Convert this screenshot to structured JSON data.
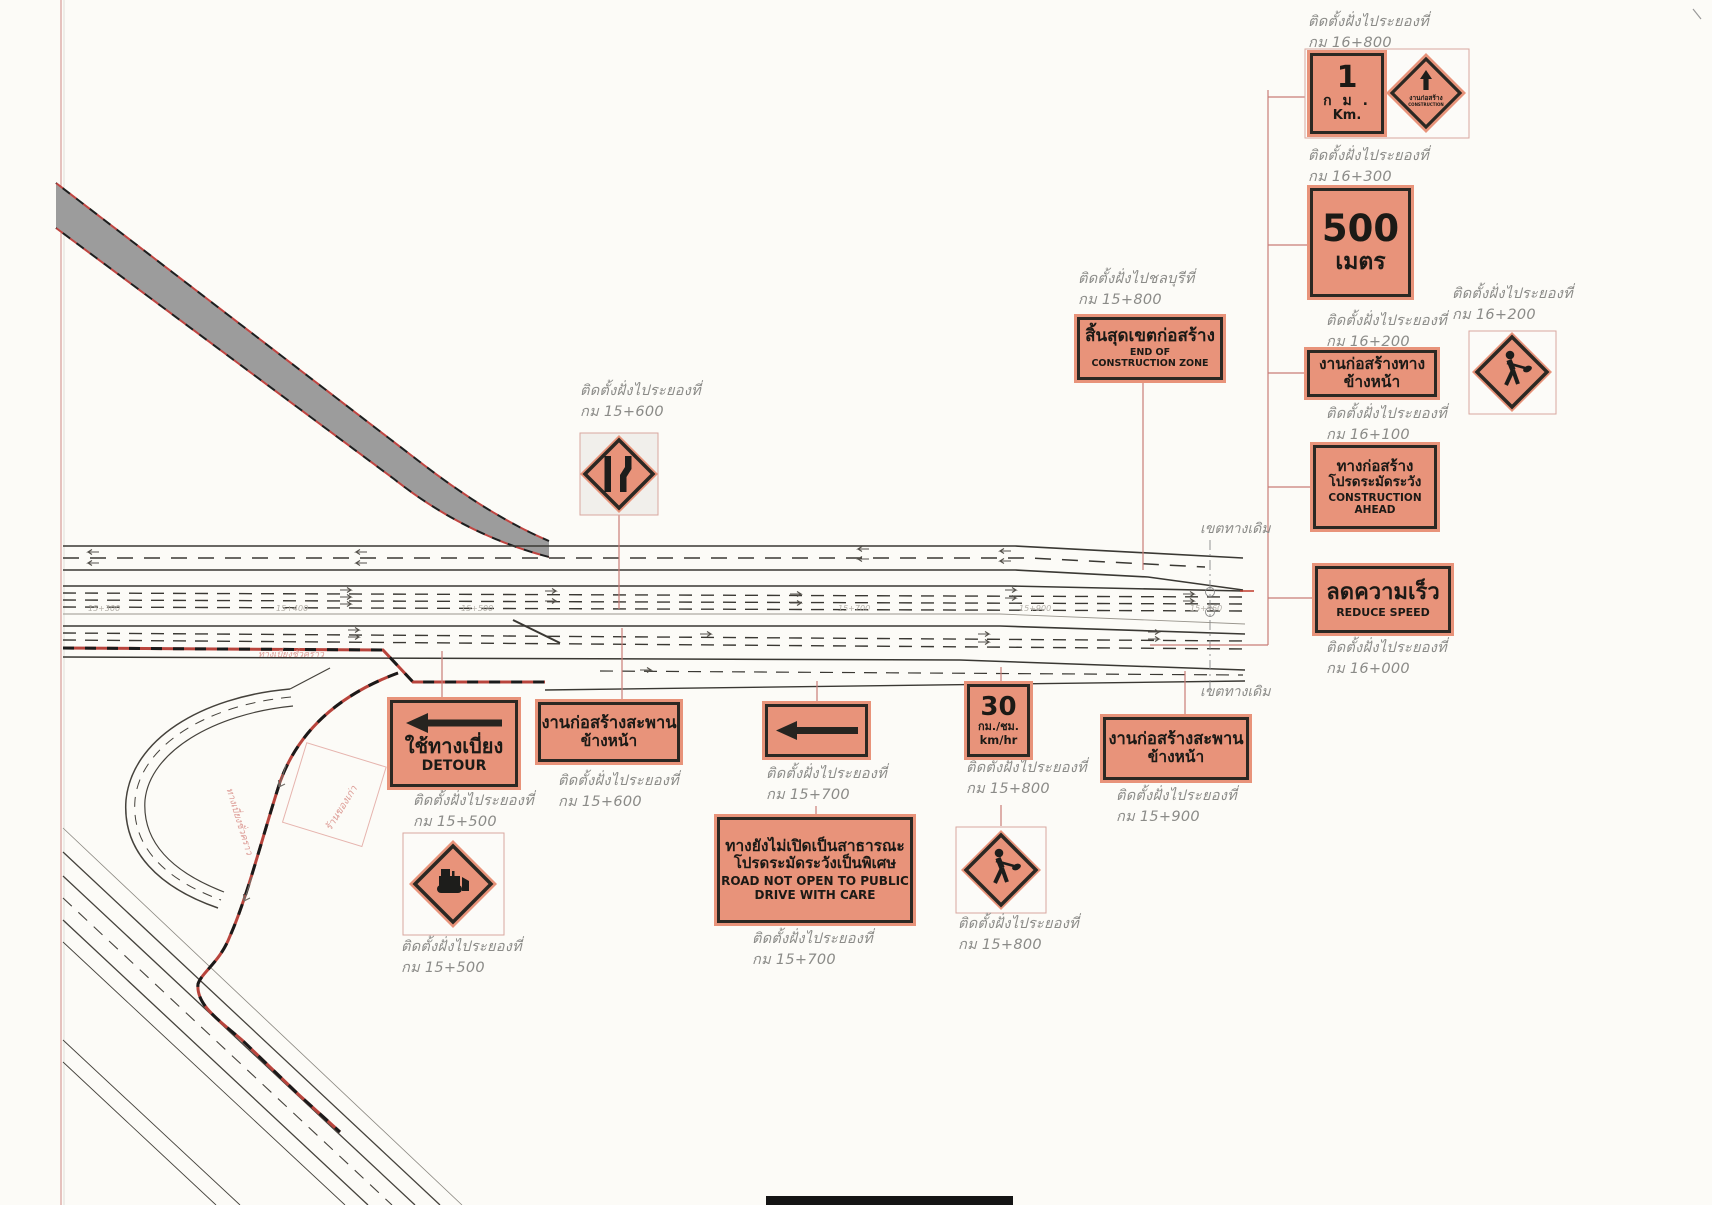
{
  "colors": {
    "sign_background": "#e8937a",
    "sign_border": "#2b2823",
    "leader_line": "#c97d77",
    "detour_route": "#b8443c",
    "label_text": "#8b8b88"
  },
  "placements": [
    {
      "prefix": "ติดตั้งฝั่งไประยองที่",
      "km": "กม  16+800"
    },
    {
      "prefix": "ติดตั้งฝั่งไประยองที่",
      "km": "กม  16+300"
    },
    {
      "prefix": "ติดตั้งฝั่งไประยองที่",
      "km": "กม  16+200"
    },
    {
      "prefix": "ติดตั้งฝั่งไประยองที่",
      "km": "กม  16+200"
    },
    {
      "prefix": "ติดตั้งฝั่งไประยองที่",
      "km": "กม  16+100"
    },
    {
      "prefix": "ติดตั้งฝั่งไประยองที่",
      "km": "กม  16+000"
    },
    {
      "prefix": "ติดตั้งฝั่งไปชลบุรีที่",
      "km": "กม  15+800"
    },
    {
      "prefix": "ติดตั้งฝั่งไประยองที่",
      "km": "กม  15+600"
    },
    {
      "prefix": "ติดตั้งฝั่งไประยองที่",
      "km": "กม  15+500"
    },
    {
      "prefix": "ติดตั้งฝั่งไประยองที่",
      "km": "กม  15+600"
    },
    {
      "prefix": "ติดตั้งฝั่งไประยองที่",
      "km": "กม  15+500"
    },
    {
      "prefix": "ติดตั้งฝั่งไประยองที่",
      "km": "กม  15+700"
    },
    {
      "prefix": "ติดตั้งฝั่งไประยองที่",
      "km": "กม  15+700"
    },
    {
      "prefix": "ติดตั้งฝั่งไประยองที่",
      "km": "กม  15+800"
    },
    {
      "prefix": "ติดตั้งฝั่งไประยองที่",
      "km": "กม  15+800"
    },
    {
      "prefix": "ติดตั้งฝั่งไประยองที่",
      "km": "กม  15+900"
    }
  ],
  "signs": {
    "km1": {
      "value": "1",
      "unit_thai": "ก ม .",
      "unit_eng": "Km."
    },
    "construction_diamond": {
      "line1": "งานก่อสร้าง",
      "line2": "CONSTRUCTION"
    },
    "m500": {
      "value": "500",
      "unit": "เมตร"
    },
    "roadwork_ahead": {
      "line1": "งานก่อสร้างทาง",
      "line2": "ข้างหน้า"
    },
    "construction_ahead": {
      "line1": "ทางก่อสร้าง",
      "line2": "โปรดระมัดระวัง",
      "line3": "CONSTRUCTION",
      "line4": "AHEAD"
    },
    "reduce_speed": {
      "line1": "ลดความเร็ว",
      "line2": "REDUCE SPEED"
    },
    "end_zone": {
      "line1": "สิ้นสุดเขตก่อสร้าง",
      "line2": "END OF",
      "line3": "CONSTRUCTION ZONE"
    },
    "detour": {
      "line1": "ใช้ทางเบี่ยง",
      "line2": "DETOUR"
    },
    "bridge_ahead": {
      "line1": "งานก่อสร้างสะพาน",
      "line2": "ข้างหน้า"
    },
    "not_open": {
      "line1": "ทางยังไม่เปิดเป็นสาธารณะ",
      "line2": "โปรดระมัดระวังเป็นพิเศษ",
      "line3": "ROAD NOT OPEN TO PUBLIC",
      "line4": "DRIVE WITH CARE"
    },
    "speed30": {
      "value": "30",
      "unit_thai": "กม./ชม.",
      "unit_eng": "km/hr"
    }
  },
  "road": {
    "boundary_label": "เขตทางเดิม",
    "detour_label": "ทางเบี่ยงชั่วคราว",
    "plot_label": "ร้านของเก่า",
    "stations": {
      "s1": "15+300",
      "s2": "15+400",
      "s3": "15+500",
      "s4": "15+700",
      "s5": "15+900",
      "s6": "15+960"
    }
  }
}
